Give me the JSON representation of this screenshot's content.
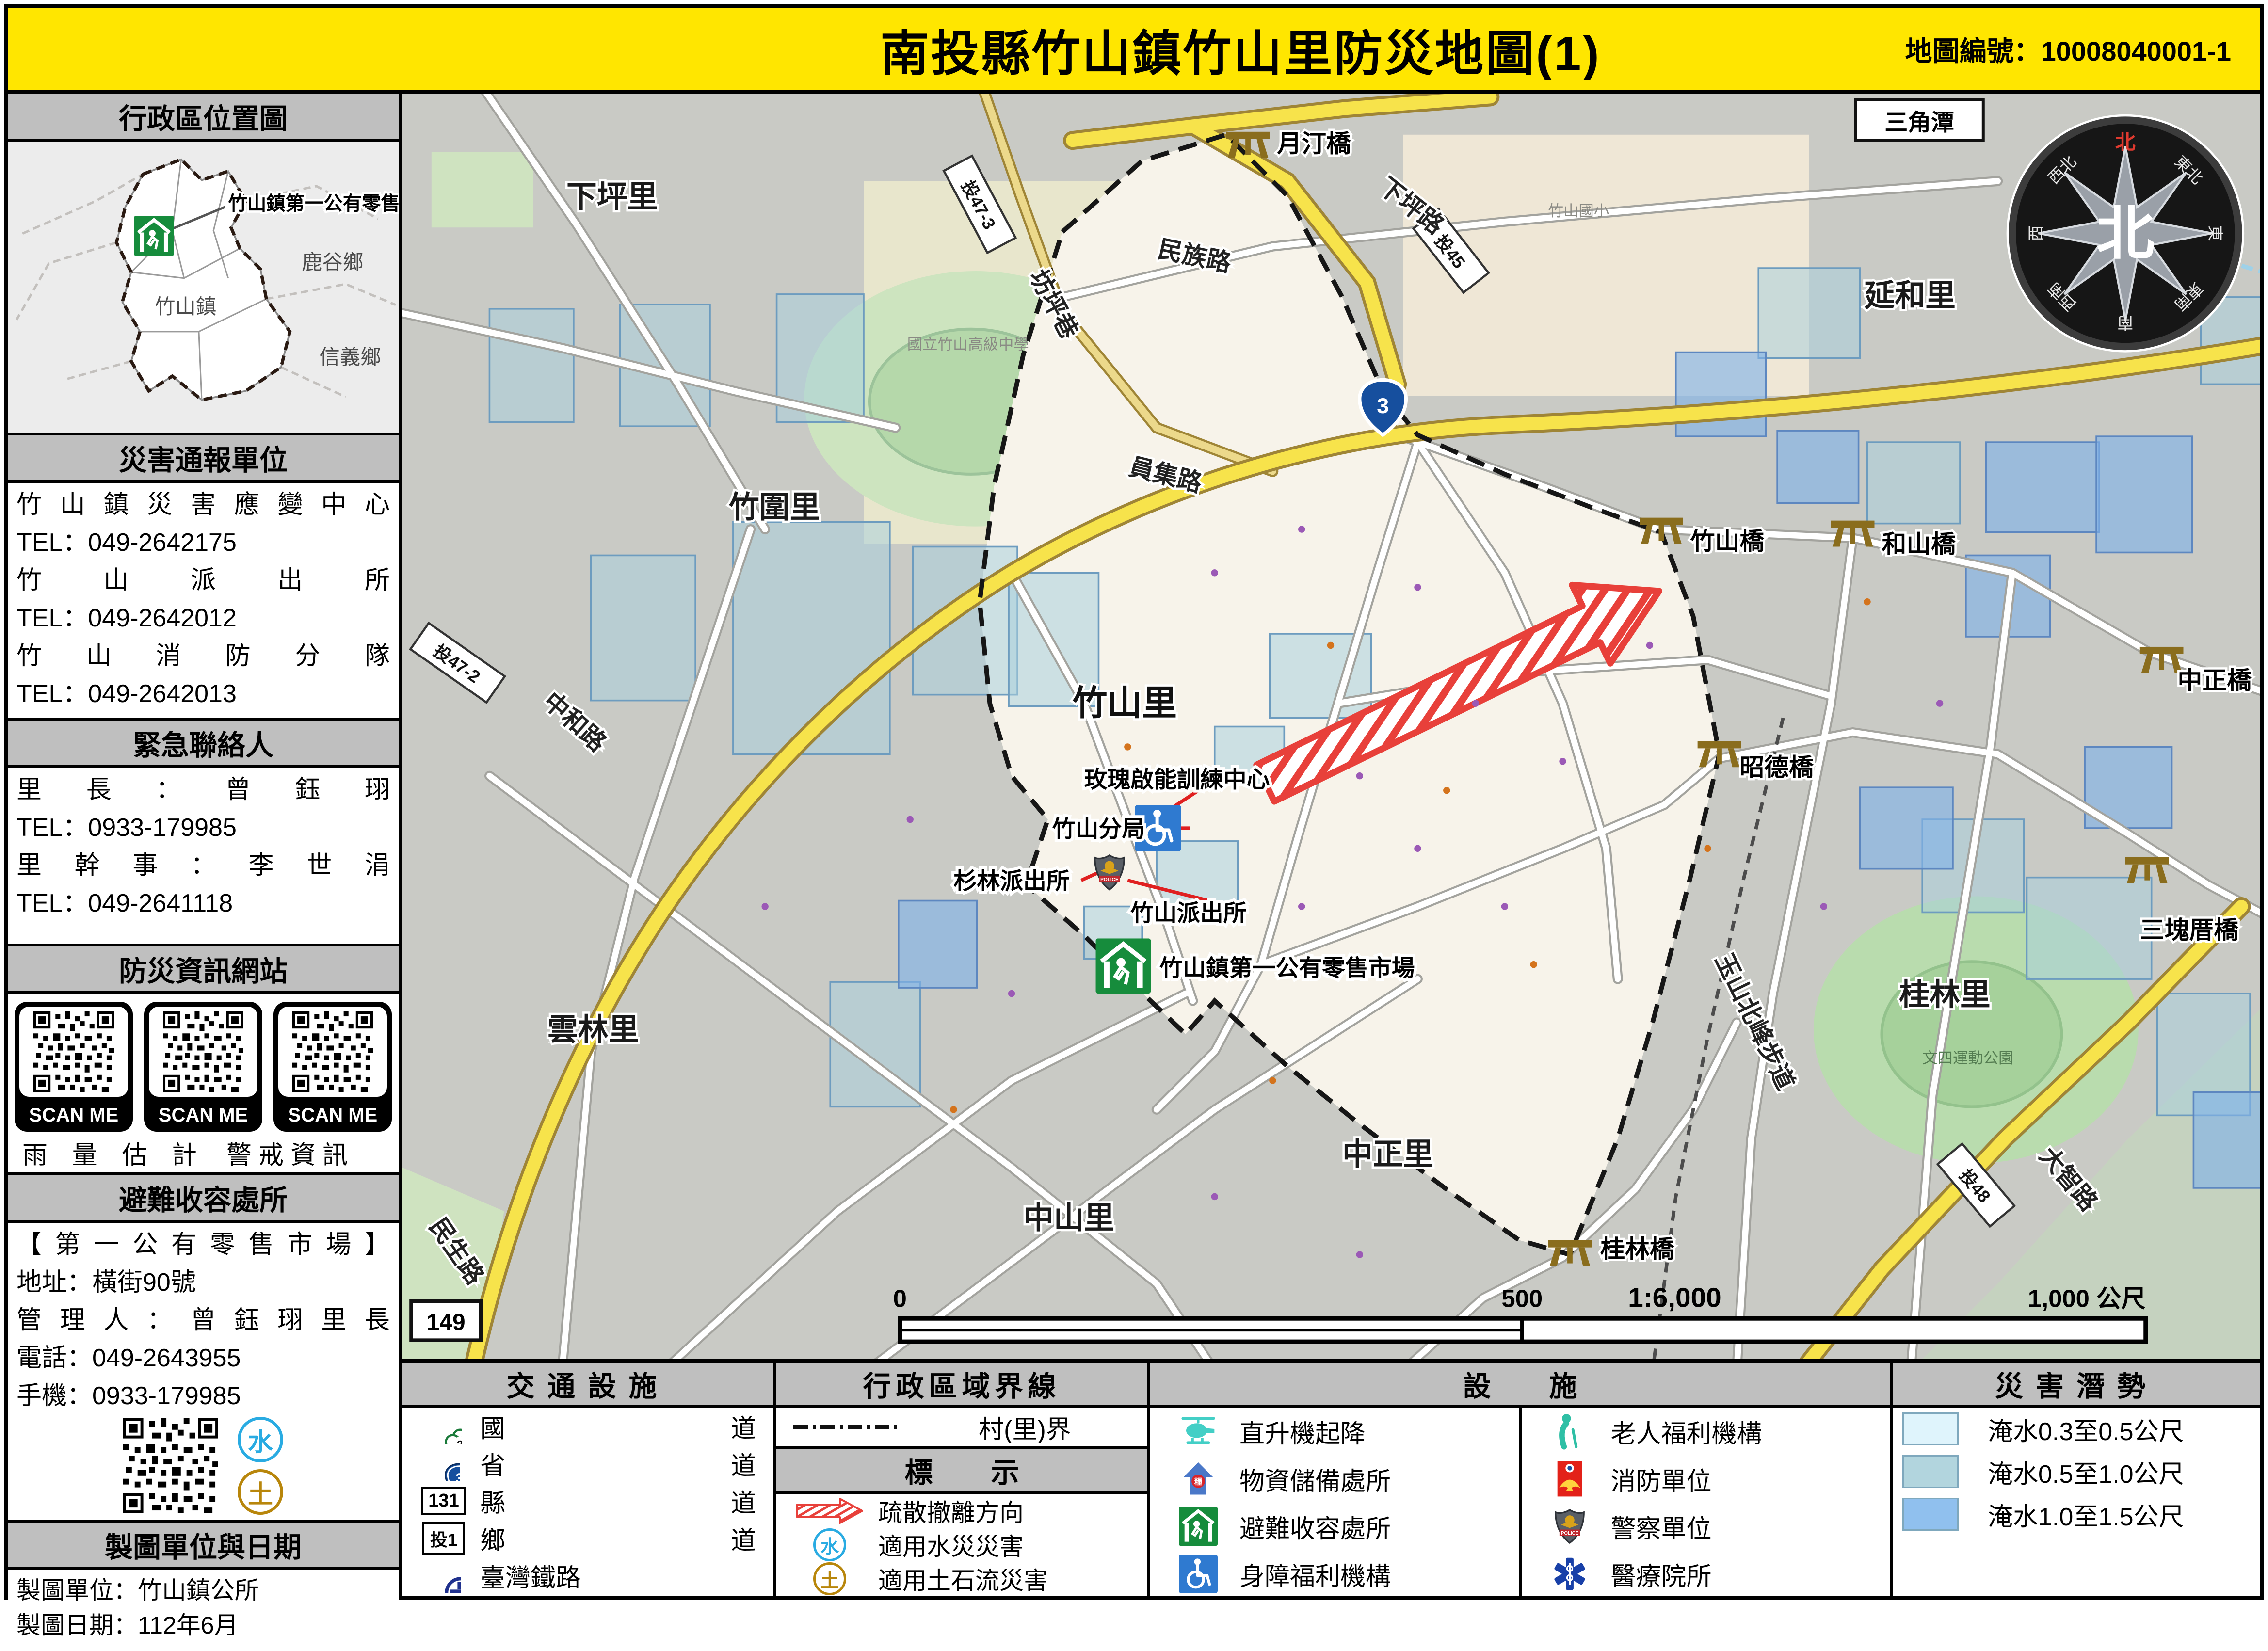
{
  "header": {
    "title": "南投縣竹山鎮竹山里防災地圖(1)",
    "map_no": "地圖編號：10008040001-1"
  },
  "sidebar": {
    "location": {
      "title": "行政區位置圖",
      "marker_label": "竹山鎮第一公有零售市場",
      "regions": [
        "鹿谷鄉",
        "竹山鎮",
        "信義鄉"
      ]
    },
    "report": {
      "title": "災害通報單位",
      "entries": [
        {
          "name": "竹山鎮災害應變中心",
          "tel": "TEL：049-2642175"
        },
        {
          "name": "竹山派出所",
          "tel": "TEL：049-2642012"
        },
        {
          "name": "竹山消防分隊",
          "tel": "TEL：049-2642013"
        }
      ]
    },
    "contacts": {
      "title": "緊急聯絡人",
      "entries": [
        {
          "name": "里長：曾鈺珝",
          "tel": "TEL：0933-179985"
        },
        {
          "name": "里幹事：李世涓",
          "tel": "TEL：049-2641118"
        }
      ]
    },
    "websites": {
      "title": "防災資訊網站",
      "scan": "SCAN ME",
      "captions": [
        "雨量估計",
        "警戒資訊"
      ]
    },
    "shelter": {
      "title": "避難收容處所",
      "name": "【第一公有零售市場】",
      "address": "地址：橫街90號",
      "manager": "管理人：曾鈺珝里長",
      "phone": "電話：049-2643955",
      "mobile": "手機：0933-179985",
      "badges": [
        "水",
        "土"
      ]
    },
    "credits": {
      "title": "製圖單位與日期",
      "unit": "製圖單位：竹山鎮公所",
      "date": "製圖日期：112年6月"
    }
  },
  "legend": {
    "transport": {
      "title": "交通設施",
      "items": [
        {
          "label": "國道",
          "badge": "3"
        },
        {
          "label": "省道",
          "badge": "3"
        },
        {
          "label": "縣道",
          "badge": "131"
        },
        {
          "label": "鄉道",
          "badge": "投1"
        },
        {
          "label": "臺灣鐵路",
          "badge": ""
        }
      ]
    },
    "boundary": {
      "title": "行政區域界線",
      "village_border": "村(里)界"
    },
    "marks": {
      "title": "標示",
      "evacuation": "疏散撤離方向",
      "flood": "適用水災災害",
      "debris": "適用土石流災害",
      "water_char": "水",
      "soil_char": "土"
    },
    "facilities": {
      "title": "設施",
      "items": [
        "直升機起降",
        "物資儲備處所",
        "避難收容處所",
        "身障福利機構",
        "老人福利機構",
        "消防單位",
        "警察單位",
        "醫療院所"
      ],
      "police_text": "POLICE",
      "supply_char": "糧"
    },
    "hazard": {
      "title": "災害潛勢",
      "items": [
        {
          "color": "#dff4fc",
          "label": "淹水0.3至0.5公尺"
        },
        {
          "color": "#b2d5de",
          "label": "淹水0.5至1.0公尺"
        },
        {
          "color": "#90c0ee",
          "label": "淹水1.0至1.5公尺"
        }
      ]
    }
  },
  "map": {
    "labels": {
      "xiapingli": "下坪里",
      "yuetingqiao": "月汀橋",
      "xiapinglu": "下坪路",
      "tou45": "投45",
      "sanjiaotan": "三角潭",
      "yanheli": "延和里",
      "minzulu": "民族路",
      "fangpingxiang": "坊坪巷",
      "tou473": "投47-3",
      "zhushanguoxiao": "竹山國小",
      "yuanjilu": "員集路",
      "zhuweili": "竹圍里",
      "zhushanqiao": "竹山橋",
      "heshanqiao": "和山橋",
      "zhongzhengqiao": "中正橋",
      "tou472": "投47-2",
      "zhonghelu": "中和路",
      "zhushanli": "竹山里",
      "zhaodeqiao": "昭德橋",
      "meigui": "玫瑰啟能訓練中心",
      "fenju": "竹山分局",
      "shanlin": "杉林派出所",
      "paichusuo": "竹山派出所",
      "shichang": "竹山鎮第一公有零售市場",
      "sankuaicuo": "三塊厝橋",
      "guilinli": "桂林里",
      "yushan": "玉山北峰步道",
      "yunlinli": "雲林里",
      "zhongzhengli": "中正里",
      "zhongshanli": "中山里",
      "minshenglu": "民生路",
      "guilinqiao": "桂林橋",
      "dazhilu": "大智路",
      "tou48": "投48",
      "wensi": "文四運動公園",
      "gaozhong": "國立竹山高級中學",
      "r149": "149",
      "n3": "3"
    },
    "scale": {
      "start": "0",
      "mid": "500",
      "ratio": "1:6,000",
      "end": "1,000 公尺"
    },
    "compass": {
      "center": "北",
      "north": "北",
      "dirs": [
        "東北",
        "東",
        "東南",
        "南",
        "西南",
        "西",
        "西北"
      ]
    }
  }
}
